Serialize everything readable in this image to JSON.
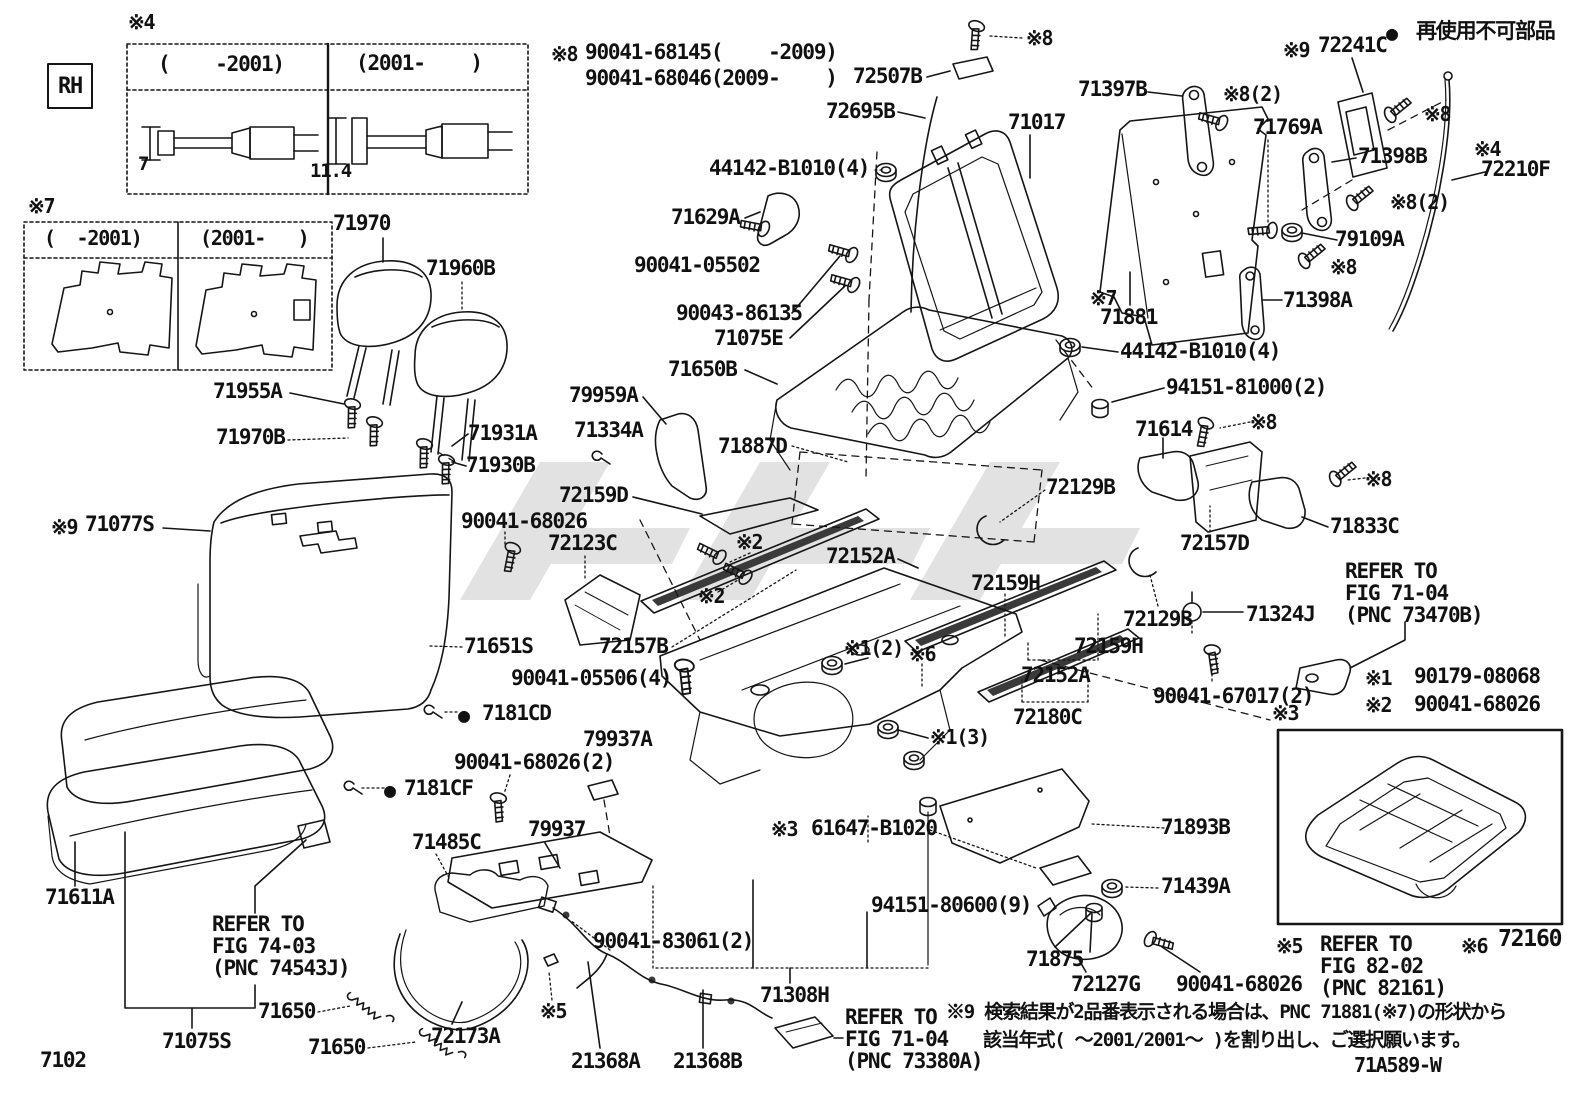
{
  "labels": [
    {
      "t": "※4",
      "x": 128,
      "y": 12,
      "s": 20
    },
    {
      "t": "RH",
      "x": 58,
      "y": 76,
      "s": 22
    },
    {
      "t": "(    -2001)",
      "x": 158,
      "y": 54
    },
    {
      "t": "(2001-    )",
      "x": 356,
      "y": 53
    },
    {
      "t": "7",
      "x": 138,
      "y": 155,
      "s": 19
    },
    {
      "t": "11.4",
      "x": 310,
      "y": 162,
      "s": 19
    },
    {
      "t": "※7",
      "x": 28,
      "y": 196,
      "s": 20
    },
    {
      "t": "(  -2001)",
      "x": 44,
      "y": 228,
      "s": 20
    },
    {
      "t": "(2001-   )",
      "x": 200,
      "y": 228,
      "s": 20
    },
    {
      "t": "※8",
      "x": 551,
      "y": 44,
      "s": 20
    },
    {
      "t": "90041-68145(    -2009)",
      "x": 585,
      "y": 42
    },
    {
      "t": "90041-68046(2009-    )",
      "x": 585,
      "y": 68
    },
    {
      "t": "72507B",
      "x": 853,
      "y": 66
    },
    {
      "t": "72695B",
      "x": 826,
      "y": 101
    },
    {
      "t": "71017",
      "x": 1008,
      "y": 112
    },
    {
      "t": "※8",
      "x": 1026,
      "y": 28,
      "s": 20
    },
    {
      "t": "44142-B1010(4)",
      "x": 709,
      "y": 158
    },
    {
      "t": "71629A",
      "x": 671,
      "y": 207
    },
    {
      "t": "90041-05502",
      "x": 634,
      "y": 255
    },
    {
      "t": "90043-86135",
      "x": 676,
      "y": 303
    },
    {
      "t": "71075E",
      "x": 714,
      "y": 328
    },
    {
      "t": "71650B",
      "x": 668,
      "y": 359
    },
    {
      "t": "79959A",
      "x": 569,
      "y": 385
    },
    {
      "t": "71334A",
      "x": 574,
      "y": 420
    },
    {
      "t": "71887D",
      "x": 718,
      "y": 436
    },
    {
      "t": "71970",
      "x": 333,
      "y": 213
    },
    {
      "t": "71960B",
      "x": 426,
      "y": 258
    },
    {
      "t": "71955A",
      "x": 213,
      "y": 381
    },
    {
      "t": "71970B",
      "x": 216,
      "y": 427
    },
    {
      "t": "71931A",
      "x": 468,
      "y": 423
    },
    {
      "t": "71930B",
      "x": 466,
      "y": 455
    },
    {
      "t": "※9",
      "x": 51,
      "y": 517,
      "s": 20
    },
    {
      "t": "71077S",
      "x": 85,
      "y": 514
    },
    {
      "t": "72159D",
      "x": 559,
      "y": 485
    },
    {
      "t": "90041-68026",
      "x": 461,
      "y": 511
    },
    {
      "t": "72123C",
      "x": 548,
      "y": 533
    },
    {
      "t": "※2",
      "x": 736,
      "y": 532,
      "s": 20
    },
    {
      "t": "※2",
      "x": 698,
      "y": 586,
      "s": 20
    },
    {
      "t": "71651S",
      "x": 464,
      "y": 636
    },
    {
      "t": "72157B",
      "x": 599,
      "y": 636
    },
    {
      "t": "90041-05506(4)",
      "x": 511,
      "y": 668
    },
    {
      "t": "●",
      "x": 458,
      "y": 705,
      "s": 20
    },
    {
      "t": "7181CD",
      "x": 482,
      "y": 703
    },
    {
      "t": "●",
      "x": 384,
      "y": 780,
      "s": 20
    },
    {
      "t": "7181CF",
      "x": 404,
      "y": 778
    },
    {
      "t": "90041-68026(2)",
      "x": 454,
      "y": 752
    },
    {
      "t": "79937A",
      "x": 583,
      "y": 729
    },
    {
      "t": "79937",
      "x": 528,
      "y": 819
    },
    {
      "t": "71485C",
      "x": 412,
      "y": 832
    },
    {
      "t": "71611A",
      "x": 45,
      "y": 887
    },
    {
      "t": "REFER TO",
      "x": 212,
      "y": 914
    },
    {
      "t": "FIG 74-03",
      "x": 212,
      "y": 936
    },
    {
      "t": "(PNC 74543J)",
      "x": 212,
      "y": 958
    },
    {
      "t": "71075S",
      "x": 162,
      "y": 1031
    },
    {
      "t": "71650",
      "x": 258,
      "y": 1001
    },
    {
      "t": "71650",
      "x": 308,
      "y": 1037
    },
    {
      "t": "72173A",
      "x": 431,
      "y": 1026
    },
    {
      "t": "7102",
      "x": 40,
      "y": 1050
    },
    {
      "t": "90041-83061(2)",
      "x": 593,
      "y": 931
    },
    {
      "t": "※5",
      "x": 540,
      "y": 1001,
      "s": 20
    },
    {
      "t": "21368A",
      "x": 571,
      "y": 1051
    },
    {
      "t": "21368B",
      "x": 673,
      "y": 1051
    },
    {
      "t": "71308H",
      "x": 760,
      "y": 985
    },
    {
      "t": "REFER TO",
      "x": 845,
      "y": 1007
    },
    {
      "t": "FIG 71-04",
      "x": 845,
      "y": 1029
    },
    {
      "t": "(PNC 73380A)",
      "x": 845,
      "y": 1051
    },
    {
      "t": "※9 検索結果が2品番表示される場合は、PNC 71881(※7)の形状から",
      "x": 946,
      "y": 1003,
      "s": 19
    },
    {
      "t": "該当年式( ～2001/2001～ )を割り出し、ご選択願います。",
      "x": 983,
      "y": 1031,
      "s": 19
    },
    {
      "t": "71A589-W",
      "x": 1354,
      "y": 1055,
      "s": 20
    },
    {
      "t": "※3",
      "x": 771,
      "y": 819,
      "s": 20
    },
    {
      "t": "61647-B1020",
      "x": 811,
      "y": 818
    },
    {
      "t": "94151-80600(9)",
      "x": 871,
      "y": 895
    },
    {
      "t": "71893B",
      "x": 1161,
      "y": 817
    },
    {
      "t": "71439A",
      "x": 1161,
      "y": 876
    },
    {
      "t": "71875",
      "x": 1026,
      "y": 949
    },
    {
      "t": "72127G",
      "x": 1071,
      "y": 974
    },
    {
      "t": "90041-68026",
      "x": 1176,
      "y": 974
    },
    {
      "t": "※1(3)",
      "x": 930,
      "y": 727,
      "s": 20
    },
    {
      "t": "72180C",
      "x": 1013,
      "y": 707
    },
    {
      "t": "90041-67017(2)",
      "x": 1153,
      "y": 686
    },
    {
      "t": "72152A",
      "x": 826,
      "y": 546
    },
    {
      "t": "72159H",
      "x": 971,
      "y": 573
    },
    {
      "t": "※1(2)",
      "x": 844,
      "y": 638,
      "s": 20
    },
    {
      "t": "※6",
      "x": 909,
      "y": 644,
      "s": 20
    },
    {
      "t": "72152A",
      "x": 1021,
      "y": 665
    },
    {
      "t": "72159H",
      "x": 1074,
      "y": 636
    },
    {
      "t": "72129B",
      "x": 1046,
      "y": 477
    },
    {
      "t": "72129B",
      "x": 1123,
      "y": 609
    },
    {
      "t": "71324J",
      "x": 1246,
      "y": 604
    },
    {
      "t": "72157D",
      "x": 1180,
      "y": 533
    },
    {
      "t": "71833C",
      "x": 1330,
      "y": 516
    },
    {
      "t": "※8",
      "x": 1365,
      "y": 469,
      "s": 20
    },
    {
      "t": "※8",
      "x": 1250,
      "y": 412,
      "s": 20
    },
    {
      "t": "71614",
      "x": 1135,
      "y": 419
    },
    {
      "t": "REFER TO",
      "x": 1345,
      "y": 561
    },
    {
      "t": "FIG 71-04",
      "x": 1345,
      "y": 583
    },
    {
      "t": "(PNC 73470B)",
      "x": 1345,
      "y": 605
    },
    {
      "t": "※1",
      "x": 1365,
      "y": 668,
      "s": 20
    },
    {
      "t": "90179-08068",
      "x": 1414,
      "y": 666
    },
    {
      "t": "※2",
      "x": 1365,
      "y": 695,
      "s": 20
    },
    {
      "t": "90041-68026",
      "x": 1414,
      "y": 694
    },
    {
      "t": "※3",
      "x": 1272,
      "y": 703,
      "s": 20
    },
    {
      "t": "※5",
      "x": 1276,
      "y": 936,
      "s": 20
    },
    {
      "t": "REFER TO",
      "x": 1320,
      "y": 934
    },
    {
      "t": "FIG 82-02",
      "x": 1320,
      "y": 956
    },
    {
      "t": "(PNC 82161)",
      "x": 1320,
      "y": 978
    },
    {
      "t": "※6",
      "x": 1461,
      "y": 936,
      "s": 20
    },
    {
      "t": "72160",
      "x": 1498,
      "y": 928,
      "s": 23
    },
    {
      "t": "※7",
      "x": 1090,
      "y": 288,
      "s": 20
    },
    {
      "t": "71881",
      "x": 1100,
      "y": 307
    },
    {
      "t": "44142-B1010(4)",
      "x": 1120,
      "y": 341
    },
    {
      "t": "94151-81000(2)",
      "x": 1166,
      "y": 377
    },
    {
      "t": "71397B",
      "x": 1078,
      "y": 79
    },
    {
      "t": "※9",
      "x": 1283,
      "y": 40,
      "s": 20
    },
    {
      "t": "72241C",
      "x": 1318,
      "y": 35
    },
    {
      "t": "●",
      "x": 1386,
      "y": 23,
      "s": 20
    },
    {
      "t": "再使用不可部品",
      "x": 1416,
      "y": 21
    },
    {
      "t": "※8(2)",
      "x": 1223,
      "y": 84,
      "s": 20
    },
    {
      "t": "71769A",
      "x": 1253,
      "y": 117
    },
    {
      "t": "71398B",
      "x": 1358,
      "y": 146
    },
    {
      "t": "※4",
      "x": 1474,
      "y": 139,
      "s": 20
    },
    {
      "t": "72210F",
      "x": 1481,
      "y": 159
    },
    {
      "t": "※8",
      "x": 1424,
      "y": 104,
      "s": 20
    },
    {
      "t": "※8(2)",
      "x": 1390,
      "y": 192,
      "s": 20
    },
    {
      "t": "79109A",
      "x": 1335,
      "y": 229
    },
    {
      "t": "※8",
      "x": 1330,
      "y": 257,
      "s": 20
    },
    {
      "t": "71398A",
      "x": 1283,
      "y": 290
    }
  ]
}
